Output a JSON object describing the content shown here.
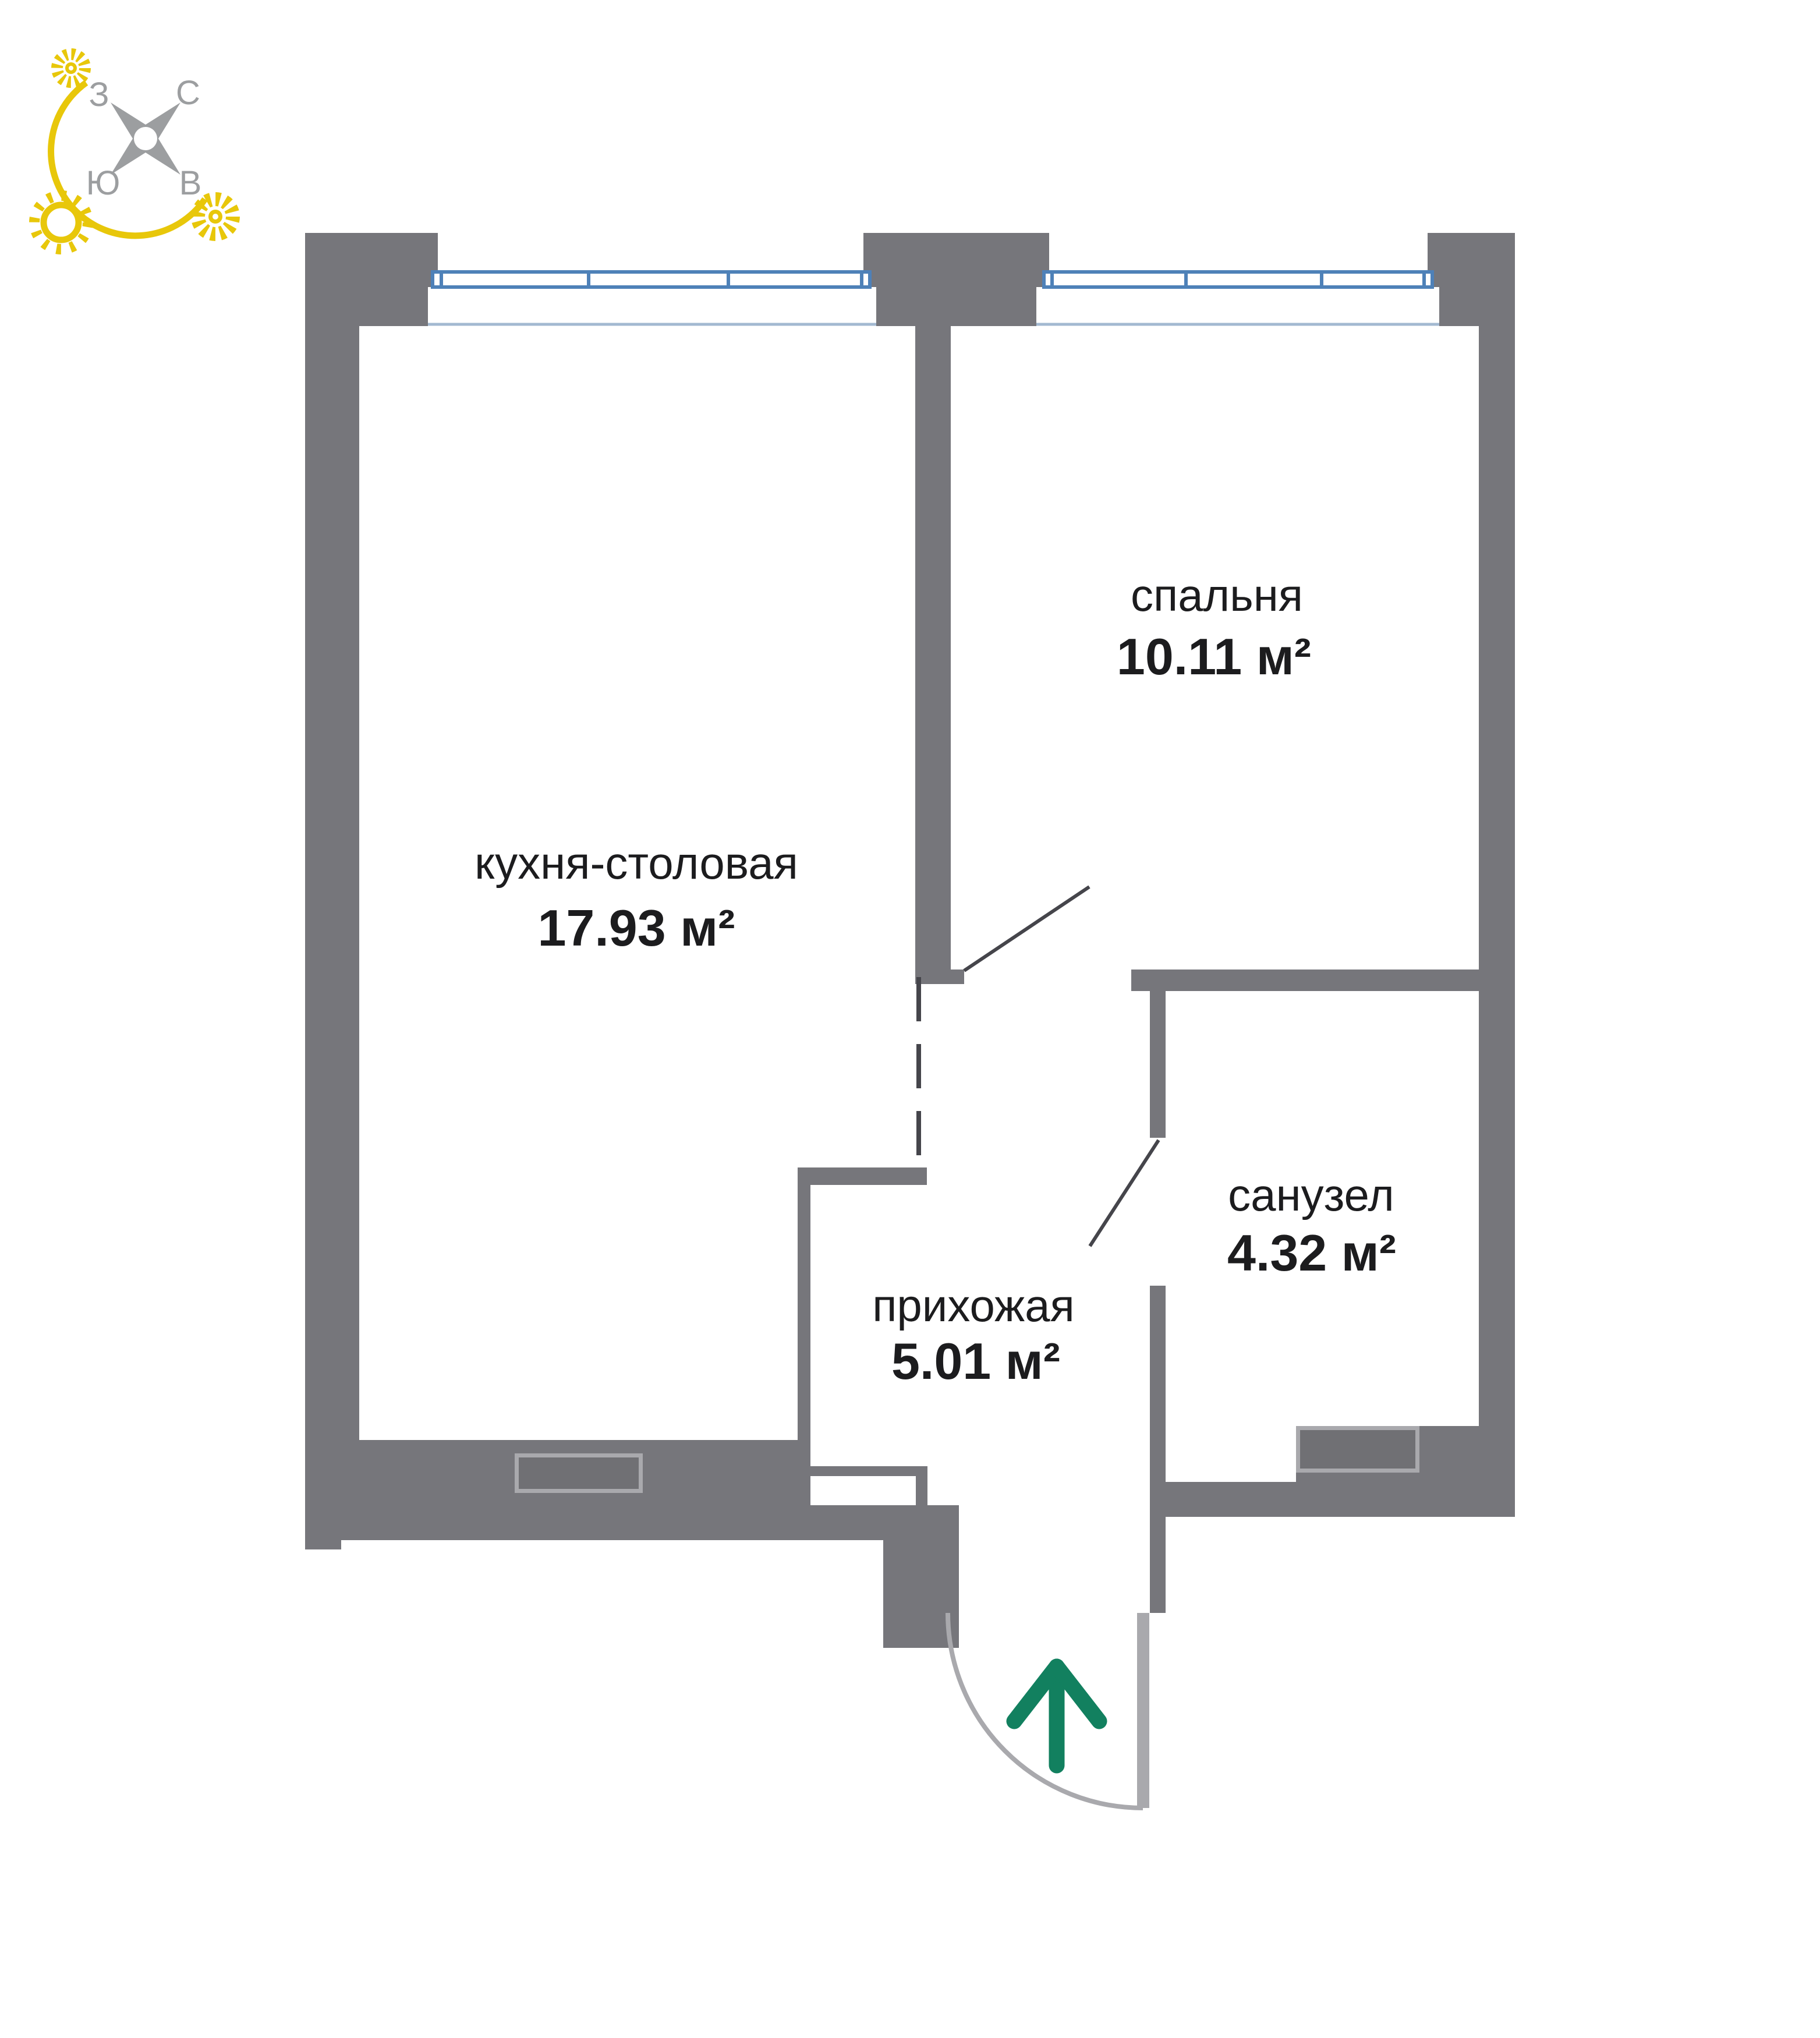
{
  "compass": {
    "west": "З",
    "north": "С",
    "south": "Ю",
    "east": "В"
  },
  "rooms": [
    {
      "id": "kitchen-dining",
      "label": "кухня-столовая",
      "area": "17.93 м²"
    },
    {
      "id": "bedroom",
      "label": "спальня",
      "area": "10.11 м²"
    },
    {
      "id": "bathroom",
      "label": "санузел",
      "area": "4.32 м²"
    },
    {
      "id": "hallway",
      "label": "прихожая",
      "area": "5.01 м²"
    }
  ],
  "colors": {
    "wall": "#76767B",
    "wall_light": "#A9A9AD",
    "window_frame": "#4E81B8",
    "window_sill_line": "#A3B9D1",
    "door_line": "#45454B",
    "text": "#1C1C1E",
    "entrance_arrow_green": "#12805F",
    "sun_yellow": "#E8C70A",
    "compass_gray": "#9C9EA0"
  }
}
